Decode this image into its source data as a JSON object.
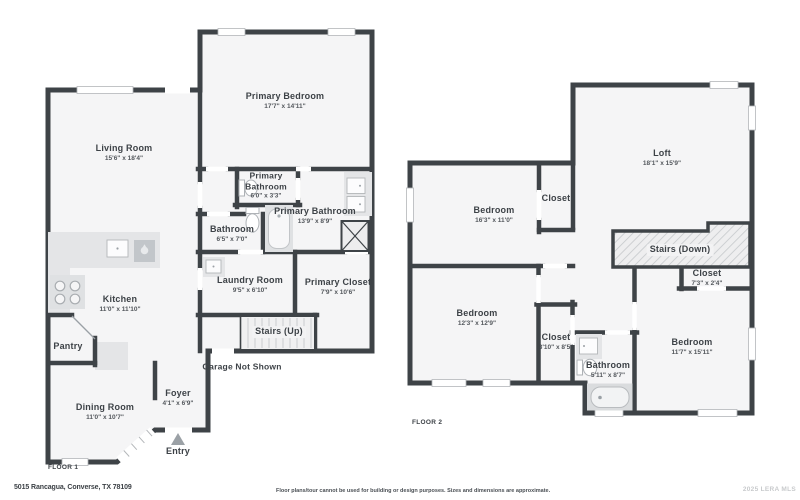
{
  "footer": {
    "address": "5015 Rancagua, Converse, TX 78109",
    "disclaimer": "Floor plans/tour cannot be used for building or design purposes. Sizes and dimensions are approximate.",
    "watermark": "2025 LERA MLS"
  },
  "floor1": {
    "label": "FLOOR 1",
    "rooms": {
      "living": {
        "name": "Living Room",
        "dims": "15'6\" x 18'4\""
      },
      "primary_bedroom": {
        "name": "Primary Bedroom",
        "dims": "17'7\" x 14'11\""
      },
      "primary_bath_wc": {
        "name1": "Primary",
        "name2": "Bathroom",
        "dims": "6'0\" x 3'3\""
      },
      "primary_bath": {
        "name": "Primary Bathroom",
        "dims": "13'9\" x 8'9\""
      },
      "bathroom": {
        "name": "Bathroom",
        "dims": "6'5\" x 7'0\""
      },
      "laundry": {
        "name": "Laundry Room",
        "dims": "9'5\" x 6'10\""
      },
      "primary_closet": {
        "name": "Primary Closet",
        "dims": "7'9\" x 10'6\""
      },
      "stairs": {
        "name": "Stairs (Up)"
      },
      "garage": {
        "name": "Garage Not Shown"
      },
      "kitchen": {
        "name": "Kitchen",
        "dims": "11'0\" x 11'10\""
      },
      "pantry": {
        "name": "Pantry"
      },
      "dining": {
        "name": "Dining Room",
        "dims": "11'0\" x 10'7\""
      },
      "foyer": {
        "name": "Foyer",
        "dims": "4'1\" x 6'9\""
      },
      "entry": {
        "name": "Entry"
      }
    }
  },
  "floor2": {
    "label": "FLOOR 2",
    "rooms": {
      "loft": {
        "name": "Loft",
        "dims": "18'1\" x 15'9\""
      },
      "bedroom1": {
        "name": "Bedroom",
        "dims": "16'3\" x 11'0\""
      },
      "closet1": {
        "name": "Closet"
      },
      "stairs": {
        "name": "Stairs (Down)"
      },
      "closet2": {
        "name": "Closet",
        "dims": "7'3\" x 2'4\""
      },
      "bedroom2": {
        "name": "Bedroom",
        "dims": "12'3\" x 12'9\""
      },
      "closet3": {
        "name": "Closet",
        "dims": "3'10\" x 8'5\""
      },
      "bathroom": {
        "name": "Bathroom",
        "dims": "5'11\" x 8'7\""
      },
      "bedroom3": {
        "name": "Bedroom",
        "dims": "11'7\" x 15'11\""
      }
    }
  },
  "colors": {
    "wall": "#3e4347",
    "floor": "#f5f5f6",
    "counter": "#e4e5e7"
  }
}
